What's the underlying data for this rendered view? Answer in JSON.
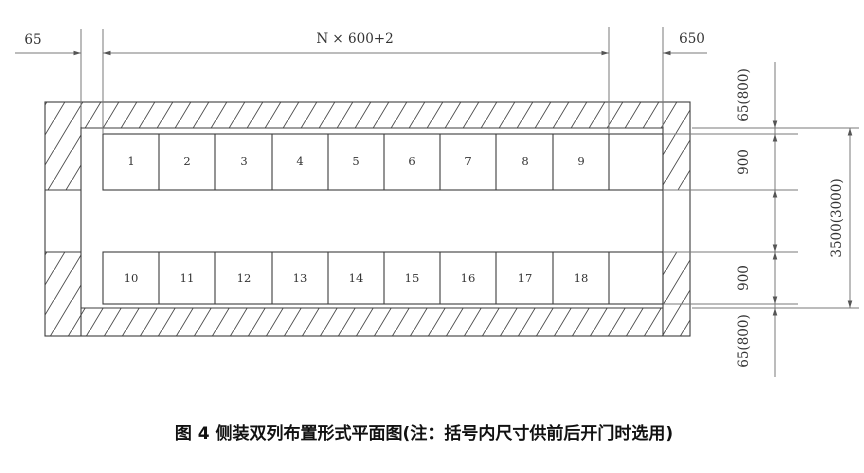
{
  "caption": "图 4  侧装双列布置形式平面图(注：括号内尺寸供前后开门时选用)",
  "cells": {
    "top": [
      "1",
      "2",
      "3",
      "4",
      "5",
      "6",
      "7",
      "8",
      "9"
    ],
    "bottom": [
      "10",
      "11",
      "12",
      "13",
      "14",
      "15",
      "16",
      "17",
      "18"
    ]
  },
  "dims": {
    "left_clearance": "65",
    "panel_span": "N × 600+2",
    "right_reserve": "650",
    "top_wall_clearance": "65(800)",
    "row_depth_top": "900",
    "row_depth_bottom": "900",
    "bottom_wall_clearance": "65(800)",
    "room_depth_total": "3500(3000)"
  },
  "colors": {
    "figure_line": "#3c3c3c",
    "dimension_line": "#7a7a7a",
    "text": "#333333",
    "background": "#ffffff"
  }
}
